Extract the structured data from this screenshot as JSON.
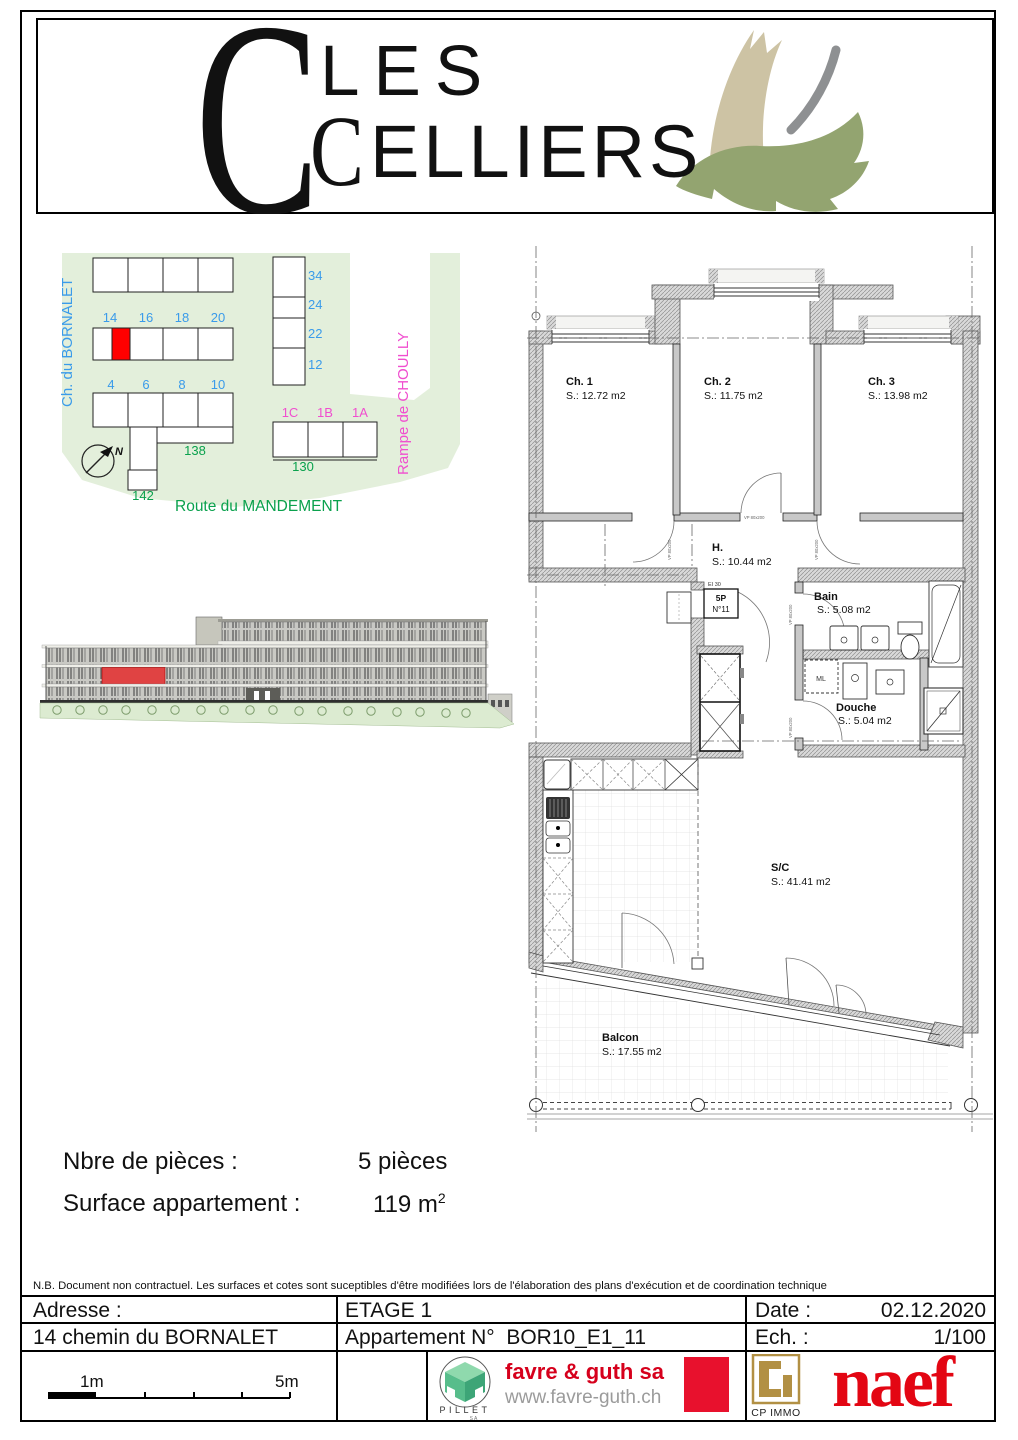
{
  "logo": {
    "c1": "C",
    "word1": "LES",
    "c2": "C",
    "word2": "ELLIERS"
  },
  "site_plan": {
    "street_left": "Ch. du BORNALET",
    "street_right": "Rampe de CHOULLY",
    "street_bottom": "Route du MANDEMENT",
    "right_col": [
      "34",
      "24",
      "22",
      "12"
    ],
    "mid_row": [
      "14",
      "16",
      "18",
      "20"
    ],
    "low_row": [
      "4",
      "6",
      "8",
      "10"
    ],
    "pink_row": [
      "1C",
      "1B",
      "1A"
    ],
    "green_nums": [
      "138",
      "130",
      "142"
    ],
    "north": "N",
    "colors": {
      "highlight_red": "#ff0000",
      "street_blue": "#3a9bea",
      "street_pink": "#f04ecf",
      "street_green": "#0aa14d",
      "ground_green": "#e3efdb"
    }
  },
  "elevation": {
    "highlight_red": "#e04343"
  },
  "floor_plan": {
    "rooms": [
      {
        "name": "Ch. 1",
        "area": "S.: 12.72 m2"
      },
      {
        "name": "Ch. 2",
        "area": "S.: 11.75 m2"
      },
      {
        "name": "Ch. 3",
        "area": "S.: 13.98 m2"
      },
      {
        "name": "H.",
        "area": "S.: 10.44 m2"
      },
      {
        "name": "Bain",
        "area": "S.: 5.08 m2"
      },
      {
        "name": "Douche",
        "area": "S.: 5.04 m2"
      },
      {
        "name": "S/C",
        "area": "S.: 41.41 m2"
      },
      {
        "name": "Balcon",
        "area": "S.: 17.55 m2"
      }
    ],
    "entry_door": {
      "fire_rating": "EI 30",
      "type": "5P",
      "number": "N°11"
    },
    "appliance_ml": "ML",
    "door_tag": "VP 80x200"
  },
  "info": {
    "rooms_label": "Nbre de pièces :",
    "rooms_value": "5 pièces",
    "surface_label": "Surface appartement :",
    "surface_value": "119 m",
    "surface_exponent": "2"
  },
  "disclaimer": "N.B. Document non contractuel. Les surfaces et cotes sont suceptibles d'être modifiées lors de l'élaboration des plans d'exécution et de coordination technique",
  "footer": {
    "address_label": "Adresse :",
    "address_value": "14 chemin du BORNALET",
    "floor_label": "ETAGE 1",
    "apartment_label": "Appartement N°",
    "apartment_value": "BOR10_E1_11",
    "date_label": "Date :",
    "date_value": "02.12.2020",
    "scale_label": "Ech. :",
    "scale_value": "1/100",
    "scalebar_1m": "1m",
    "scalebar_5m": "5m"
  },
  "brands": {
    "pillet_name": "PILLET",
    "pillet_sub": "SA",
    "favre_name": "favre & guth sa",
    "favre_url": "www.favre-guth.ch",
    "cpimmo_name": "CP IMMO",
    "naef_name": "naef",
    "colors": {
      "favre_red": "#d6001c",
      "naef_red": "#e30613",
      "cp_gold": "#b29044",
      "pillet_green": "#4db582"
    }
  }
}
